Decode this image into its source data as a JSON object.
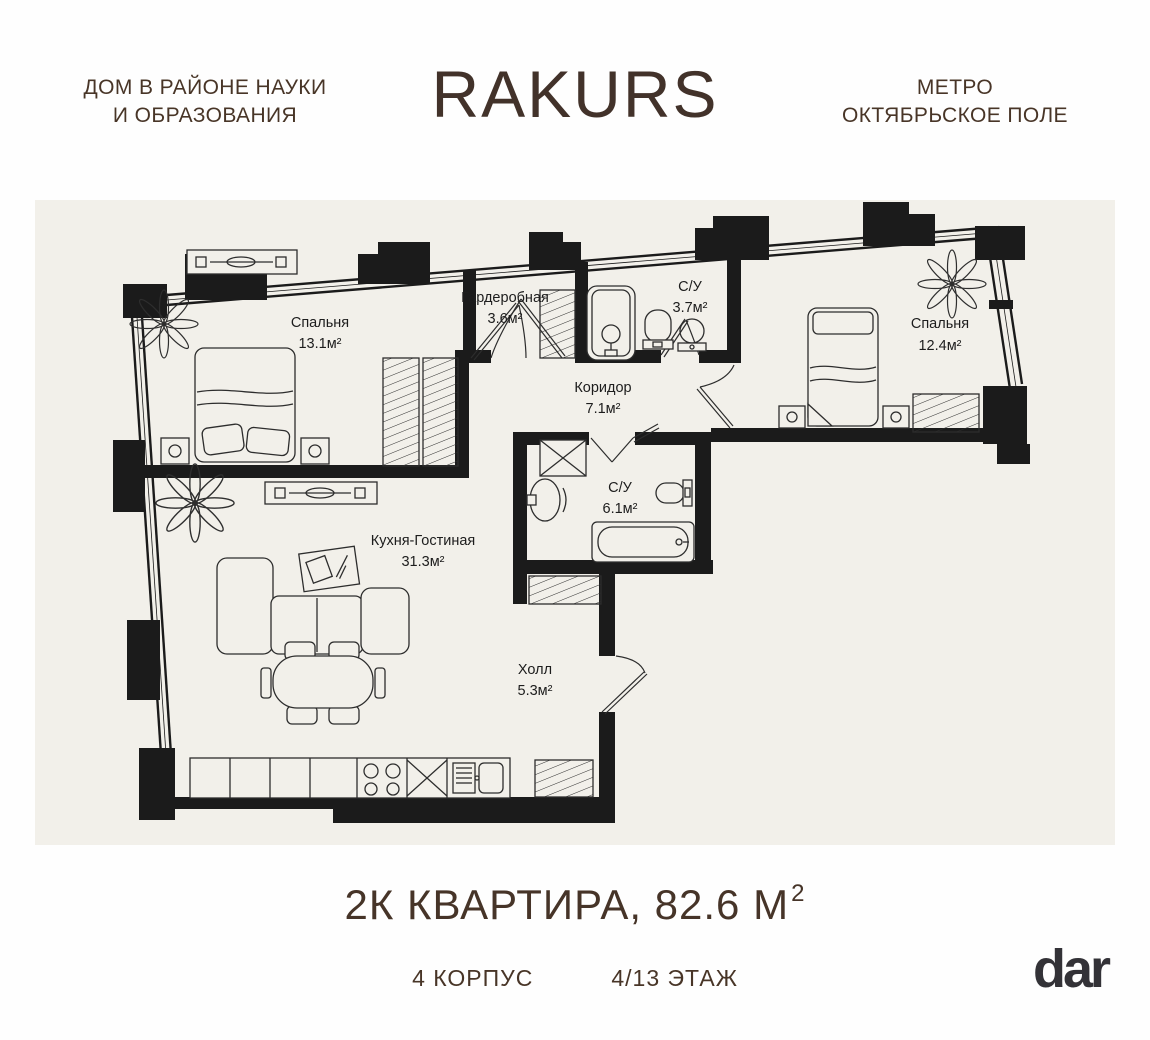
{
  "header": {
    "left_tagline": "ДОМ В РАЙОНЕ НАУКИ\nИ ОБРАЗОВАНИЯ",
    "brand": "RAKURS",
    "right_tagline": "МЕТРО\nОКТЯБРЬСКОЕ ПОЛЕ"
  },
  "plan": {
    "rooms": [
      {
        "name": "Спальня",
        "area": "13.1м²"
      },
      {
        "name": "Гардеробная",
        "area": "3.6м²"
      },
      {
        "name": "С/У",
        "area": "3.7м²"
      },
      {
        "name": "Спальня",
        "area": "12.4м²"
      },
      {
        "name": "Коридор",
        "area": "7.1м²"
      },
      {
        "name": "С/У",
        "area": "6.1м²"
      },
      {
        "name": "Кухня-Гостиная",
        "area": "31.3м²"
      },
      {
        "name": "Холл",
        "area": "5.3м²"
      }
    ]
  },
  "footer": {
    "title_main": "2К КВАРТИРА, 82.6 М",
    "title_sup": "2",
    "building": "4 КОРПУС",
    "floor": "4/13 ЭТАЖ",
    "logo": "dar"
  },
  "colors": {
    "accent_brown": "#473428",
    "wall_black": "#1b1b1b",
    "plan_background": "#f2f0ea",
    "logo_dark": "#333237"
  }
}
